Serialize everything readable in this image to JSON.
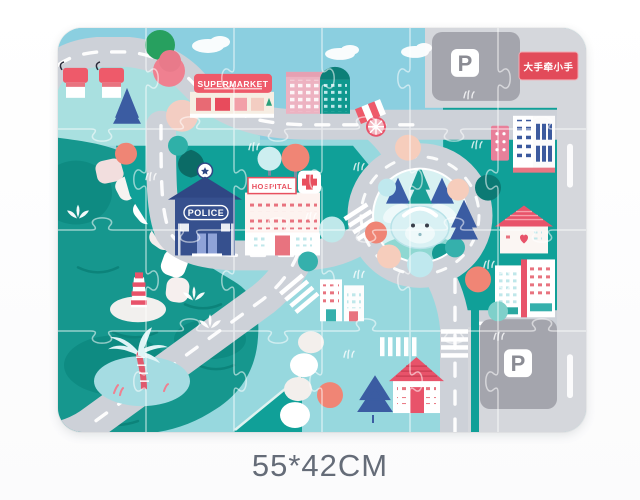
{
  "page": {
    "dimensions_label": "55*42CM"
  },
  "puzzle": {
    "brand_badge_text": "大手牵小手",
    "supermarket_sign": "SUPERMARKET",
    "police_sign": "POLICE",
    "hospital_sign": "HOSPITAL",
    "parking_sign_top": "P",
    "parking_sign_bottom": "P",
    "colors": {
      "water_teal": "#16978e",
      "grass_teal": "#10a098",
      "sky_blue": "#92d6e0",
      "road_gray": "#cdd1d8",
      "parking_pad_gray": "#a4a5ad",
      "accent_red": "#e8505f",
      "navy_blue": "#36508e"
    }
  }
}
